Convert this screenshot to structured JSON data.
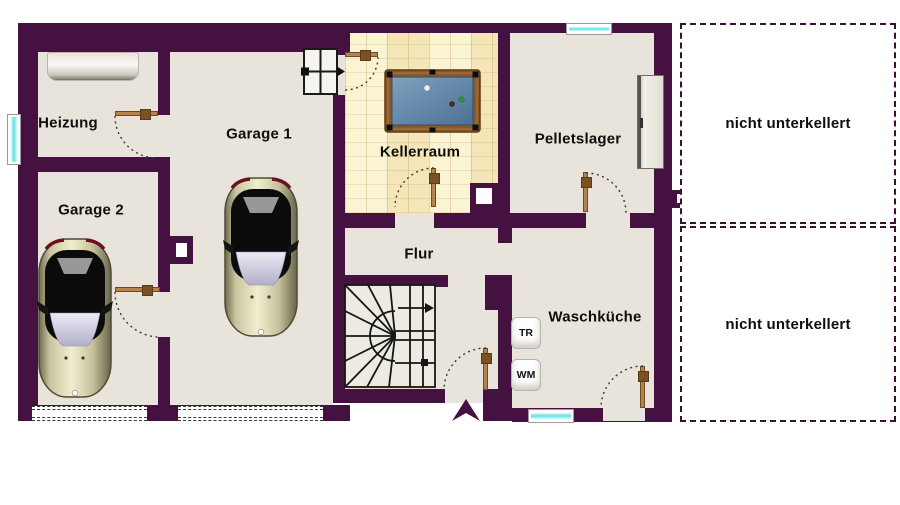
{
  "floorplan": {
    "rooms": {
      "heizung": {
        "label": "Heizung"
      },
      "garage1": {
        "label": "Garage 1"
      },
      "garage2": {
        "label": "Garage 2"
      },
      "kellerraum": {
        "label": "Kellerraum"
      },
      "pelletslager": {
        "label": "Pelletslager"
      },
      "flur": {
        "label": "Flur"
      },
      "waschkueche": {
        "label": "Waschküche"
      }
    },
    "appliances": {
      "dryer": {
        "label": "TR"
      },
      "washer": {
        "label": "WM"
      }
    },
    "annotations": {
      "no_basement_top": {
        "label": "nicht unterkellert"
      },
      "no_basement_bottom": {
        "label": "nicht unterkellert"
      }
    },
    "colors": {
      "wall": "#441140",
      "floor": "#e8e4db",
      "kellerraum_tile": "#f7efc7",
      "window_glass": "#5fe2ea",
      "door_wood": "#b5834f",
      "billiard_frame": "#8a5a2a",
      "billiard_felt": "#5f86aa",
      "car_body": "#d9d5ae",
      "background": "#ffffff"
    }
  }
}
